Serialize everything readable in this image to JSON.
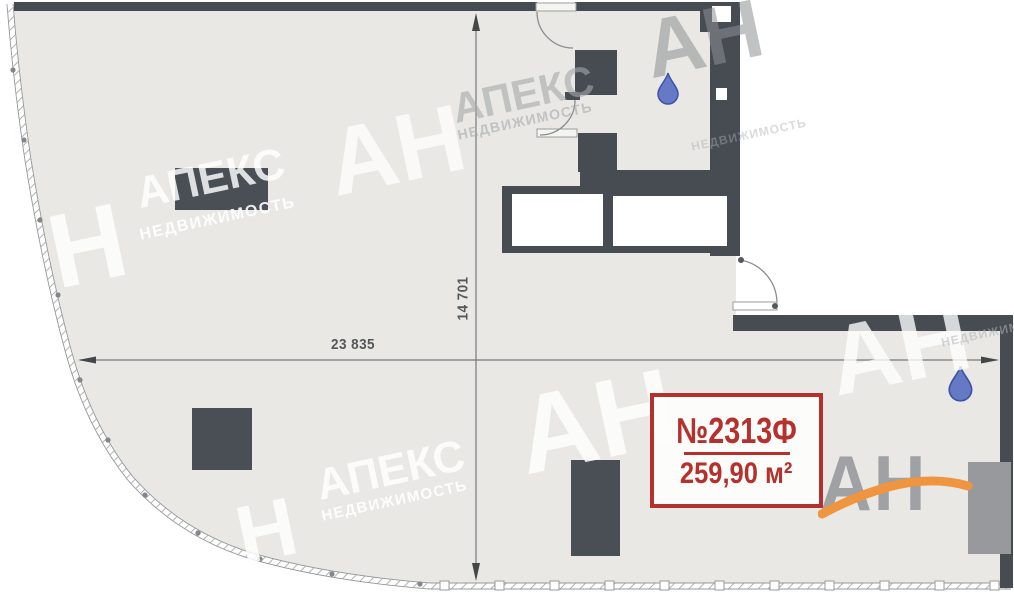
{
  "floorplan": {
    "dimensions": {
      "width": "23 835",
      "height": "14 701"
    },
    "unit_label": {
      "number": "№2313Ф",
      "area": "259,90 м²"
    },
    "watermark": {
      "abbr": "АН",
      "abbr_single": "Н",
      "brand": "АПЕКС",
      "brand_sub": "НЕДВИЖИМОСТЬ"
    },
    "logo": {
      "text": "АН"
    },
    "icons": {
      "water_drop": "water-drop-icon"
    },
    "colors": {
      "wall": "#474b52",
      "floor": "#e9e8e4",
      "accent_red": "#b4312d",
      "drop_blue": "#6679c5",
      "logo_orange": "#f0953f"
    }
  }
}
